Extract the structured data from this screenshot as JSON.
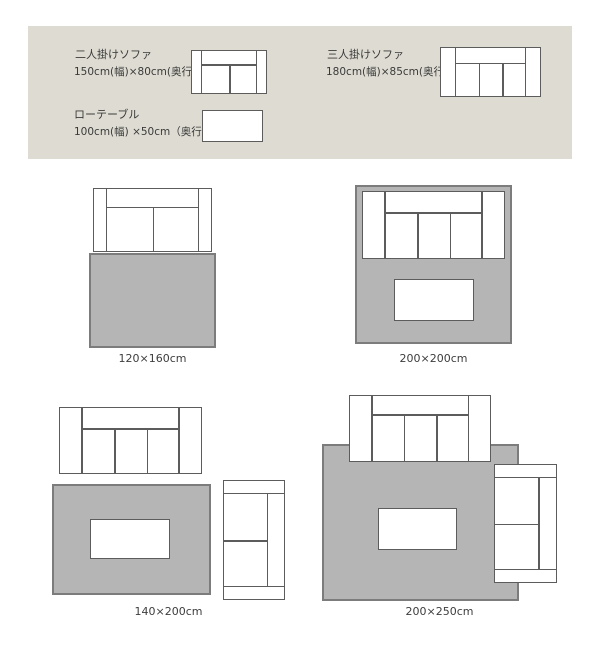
{
  "legend": {
    "items": [
      {
        "name": "二人掛けソファ",
        "size": "150cm(幅)×80cm(奥行)",
        "icon": "two-seat-sofa-icon"
      },
      {
        "name": "三人掛けソファ",
        "size": "180cm(幅)×85cm(奥行)",
        "icon": "three-seat-sofa-icon"
      },
      {
        "name": "ローテーブル",
        "size": "100cm(幅) ×50cm（奥行）",
        "icon": "low-table-icon"
      }
    ]
  },
  "diagrams": [
    {
      "id": "120x160",
      "label": "120×160cm",
      "furniture": [
        "two-seat-sofa",
        "rug"
      ]
    },
    {
      "id": "200x200",
      "label": "200×200cm",
      "furniture": [
        "three-seat-sofa",
        "low-table",
        "rug"
      ]
    },
    {
      "id": "140x200",
      "label": "140×200cm",
      "furniture": [
        "three-seat-sofa",
        "low-table",
        "rotated-two-seat-sofa",
        "rug"
      ]
    },
    {
      "id": "200x250",
      "label": "200×250cm",
      "furniture": [
        "three-seat-sofa",
        "low-table",
        "rotated-two-seat-sofa",
        "rug"
      ]
    }
  ],
  "colors": {
    "banner_bg": "#dedcd2",
    "rug_fill": "#b5b5b5",
    "rug_border": "#7c7c7c",
    "furniture_outline": "#5c5c5c",
    "text": "#3d3d3d"
  }
}
